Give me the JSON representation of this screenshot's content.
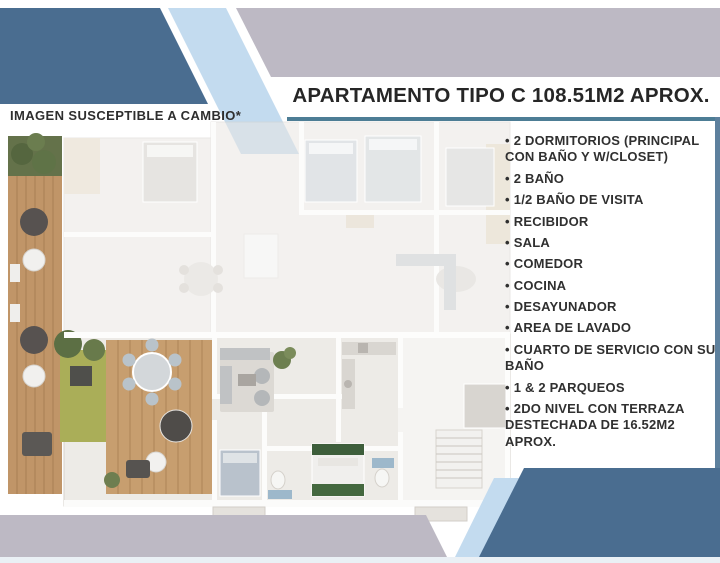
{
  "header": {
    "title": "APARTAMENTO TIPO C 108.51M2 APROX."
  },
  "plan": {
    "note": "IMAGEN SUSCEPTIBLE A CAMBIO*",
    "description": "3D top-down render of apartment type C floor plan with wood deck terrace, garden patches and furnished rooms"
  },
  "features": {
    "bullet": "•",
    "items": [
      "2 DORMITORIOS (PRINCIPAL CON BAÑO Y W/CLOSET)",
      "2 BAÑO",
      "1/2 BAÑO DE VISITA",
      "RECIBIDOR",
      "SALA",
      "COMEDOR",
      "COCINA",
      "DESAYUNADOR",
      "AREA DE LAVADO",
      "CUARTO DE SERVICIO CON SU BAÑO",
      "1 & 2 PARQUEOS",
      "2DO NIVEL CON TERRAZA DESTECHADA DE 16.52M2 APROX."
    ]
  },
  "colors": {
    "dark_blue": "#4a6d90",
    "light_blue": "#c3dbef",
    "grey_band": "#bdb9c4",
    "accent_line": "#4d7d95",
    "right_bar": "#5d809d",
    "deck_wood": "#c09568",
    "grass_olive": "#aaae58",
    "planter_green": "#64724a"
  }
}
